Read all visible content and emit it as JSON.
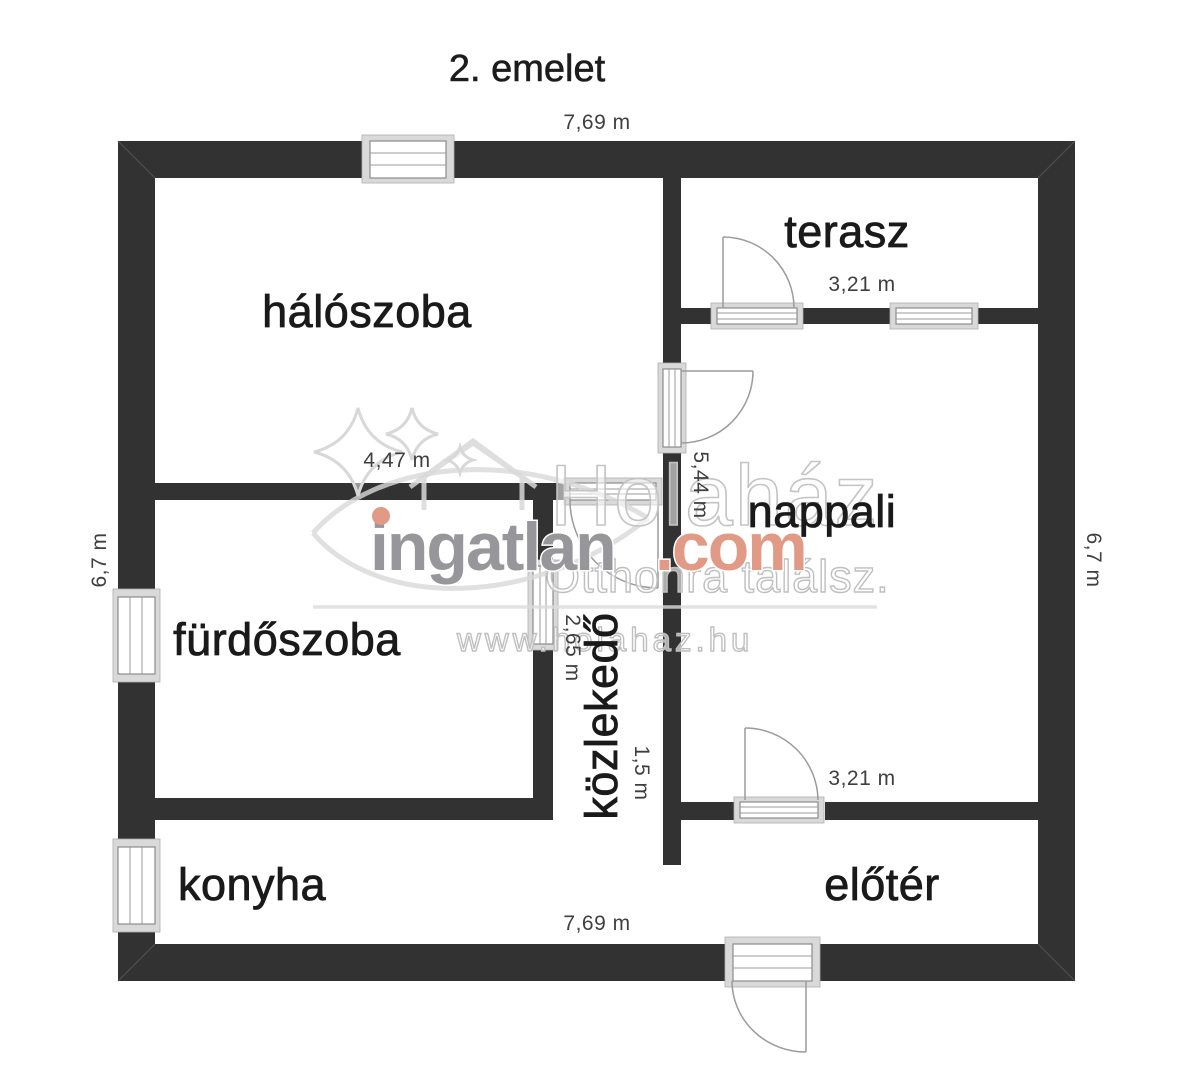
{
  "title": "2. emelet",
  "rooms": {
    "haloszoba": "hálószoba",
    "terasz": "terasz",
    "nappali": "nappali",
    "furdoszoba": "fürdőszoba",
    "kozlekedo": "közlekedő",
    "konyha": "konyha",
    "eloter": "előtér"
  },
  "dimensions": {
    "width_top": "7,69 m",
    "width_bottom": "7,69 m",
    "height_left": "6,7 m",
    "height_right": "6,7 m",
    "haloszoba_width": "4,47 m",
    "terasz_width": "3,21 m",
    "nappali_height": "5,44 m",
    "kozlekedo_length": "2,65 m",
    "kozlekedo_width": "1,5 m",
    "eloter_width": "3,21 m"
  },
  "watermark": {
    "brand": "ingatlan",
    "brand_tld": ".com",
    "ghost": "Holaház",
    "tagline": "Otthonra találsz.",
    "url": "www.holahaz.hu"
  },
  "colors": {
    "wall": "#323232",
    "accent": "#e09a85",
    "room_label": "#1a1a1a",
    "dim_label": "#3f3f3f"
  }
}
